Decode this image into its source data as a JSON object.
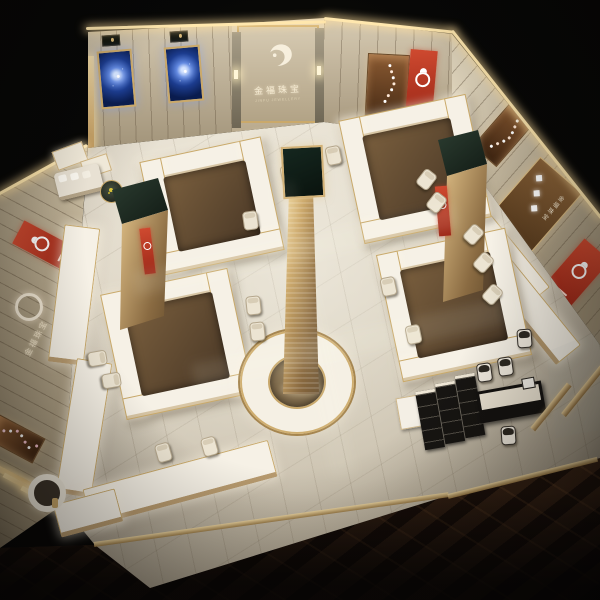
{
  "brand": {
    "name_cn": "金福珠宝",
    "name_en": "JINFU JEWELLERY"
  },
  "signage": {
    "center_wall_cn": "金福珠宝",
    "center_wall_en": "JINFU JEWELLERY",
    "left_wall_cn": "金福珠宝",
    "right_wall_cn": "金福珠宝"
  },
  "glyphs": {
    "diamond": "◆"
  },
  "colors": {
    "gold_trim": "#c9a96a",
    "counter_white": "#f6f1e6",
    "banner_red": "#b5341f",
    "screen_blue": "#16357c",
    "floor_tile": "#d8d0c1",
    "marble_dark": "#2a1a11",
    "wood": "#6b5335",
    "tower_top_green": "#1d2b23"
  }
}
